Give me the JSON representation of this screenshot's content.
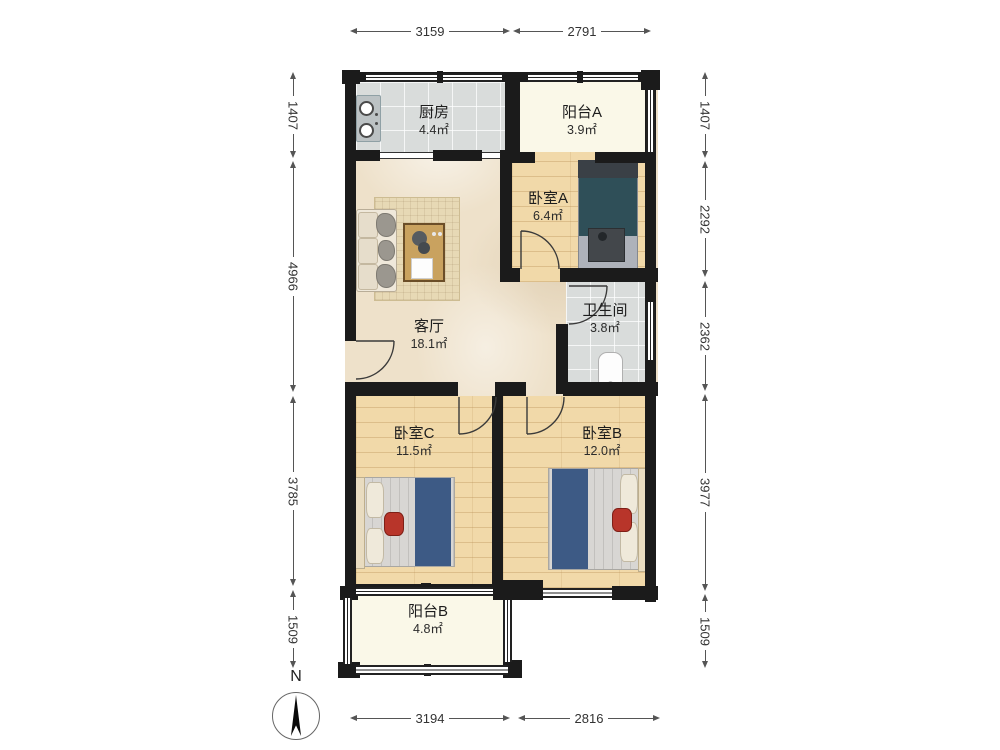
{
  "north": {
    "label": "N"
  },
  "rooms": [
    {
      "id": "kitchen",
      "name": "厨房",
      "area": "4.4㎡"
    },
    {
      "id": "balcony_a",
      "name": "阳台A",
      "area": "3.9㎡"
    },
    {
      "id": "bedroom_a",
      "name": "卧室A",
      "area": "6.4㎡"
    },
    {
      "id": "bathroom",
      "name": "卫生间",
      "area": "3.8㎡"
    },
    {
      "id": "living_room",
      "name": "客厅",
      "area": "18.1㎡"
    },
    {
      "id": "bedroom_c",
      "name": "卧室C",
      "area": "11.5㎡"
    },
    {
      "id": "bedroom_b",
      "name": "卧室B",
      "area": "12.0㎡"
    },
    {
      "id": "balcony_b",
      "name": "阳台B",
      "area": "4.8㎡"
    }
  ],
  "dimensions": {
    "top": [
      "3159",
      "2791"
    ],
    "bottom": [
      "3194",
      "2816"
    ],
    "left": [
      "1407",
      "4966",
      "3785",
      "1509"
    ],
    "right": [
      "1407",
      "2292",
      "2362",
      "3977",
      "1509"
    ]
  },
  "colors": {
    "wall": "#1b1b1b",
    "tile": "#d9dcdb",
    "wood": "#f1d9a9",
    "balcony": "#faf8e8",
    "marble": "#eee1ca",
    "rug": "#e7d9b5",
    "table": "#c9a25f",
    "teal": "#2f4f58",
    "blue": "#3d5a85",
    "red": "#b8352a"
  }
}
